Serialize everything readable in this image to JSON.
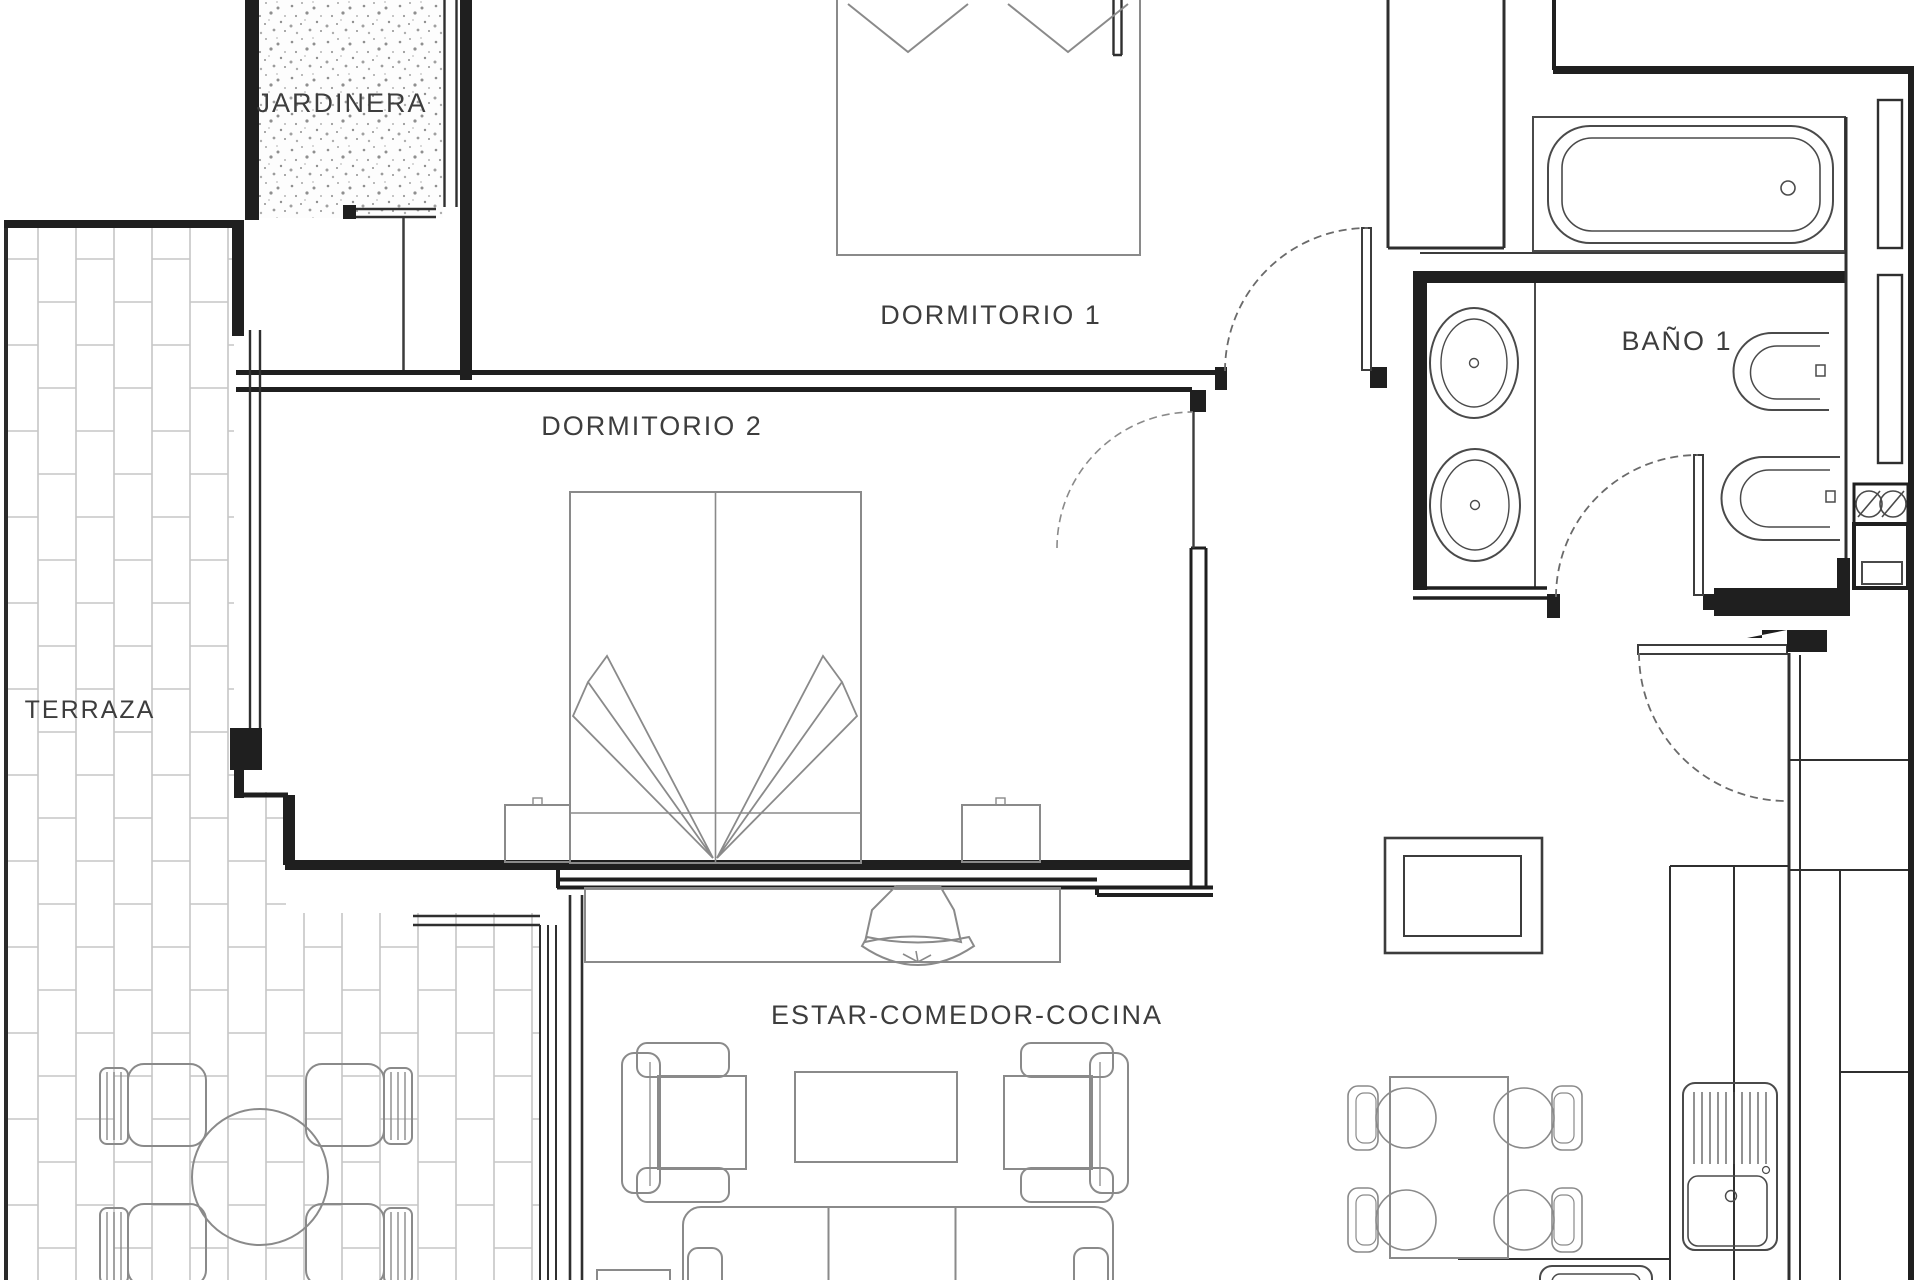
{
  "plan": {
    "type": "apartment-floor-plan",
    "colors": {
      "background": "#ffffff",
      "wall": "#1f1f1f",
      "fixture_line": "#4a4a4a",
      "furniture_line": "#8a8a8a",
      "brick_line": "#c6c6c6",
      "stipple_dot": "#8f8f8f",
      "label_text": "#3d3d3d"
    },
    "rooms": {
      "jardinera": {
        "label": "JARDINERA",
        "features": [
          "planter-stipple-fill",
          "window"
        ]
      },
      "terraza": {
        "label": "TERRAZA",
        "features": [
          "tile-paving",
          "round-table",
          "four-chairs"
        ]
      },
      "dormitorio1": {
        "label": "DORMITORIO 1",
        "features": [
          "double-bed",
          "pillows",
          "swing-door"
        ]
      },
      "dormitorio2": {
        "label": "DORMITORIO 2",
        "features": [
          "double-bed",
          "two-nightstands",
          "window",
          "swing-door"
        ]
      },
      "bano1": {
        "label": "BAÑO 1",
        "features": [
          "bathtub",
          "double-sink-vanity",
          "toilet",
          "bidet",
          "washer-column",
          "swing-door",
          "two-windows"
        ]
      },
      "estar_comedor_cocina": {
        "label": "ESTAR-COMEDOR-COCINA",
        "features": [
          "sofa",
          "two-armchairs",
          "coffee-table",
          "tv-on-sideboard",
          "square-table",
          "dining-table-four-chairs",
          "kitchen-counter",
          "sink-with-drainboard",
          "tall-cabinets",
          "entry-door"
        ]
      }
    }
  }
}
